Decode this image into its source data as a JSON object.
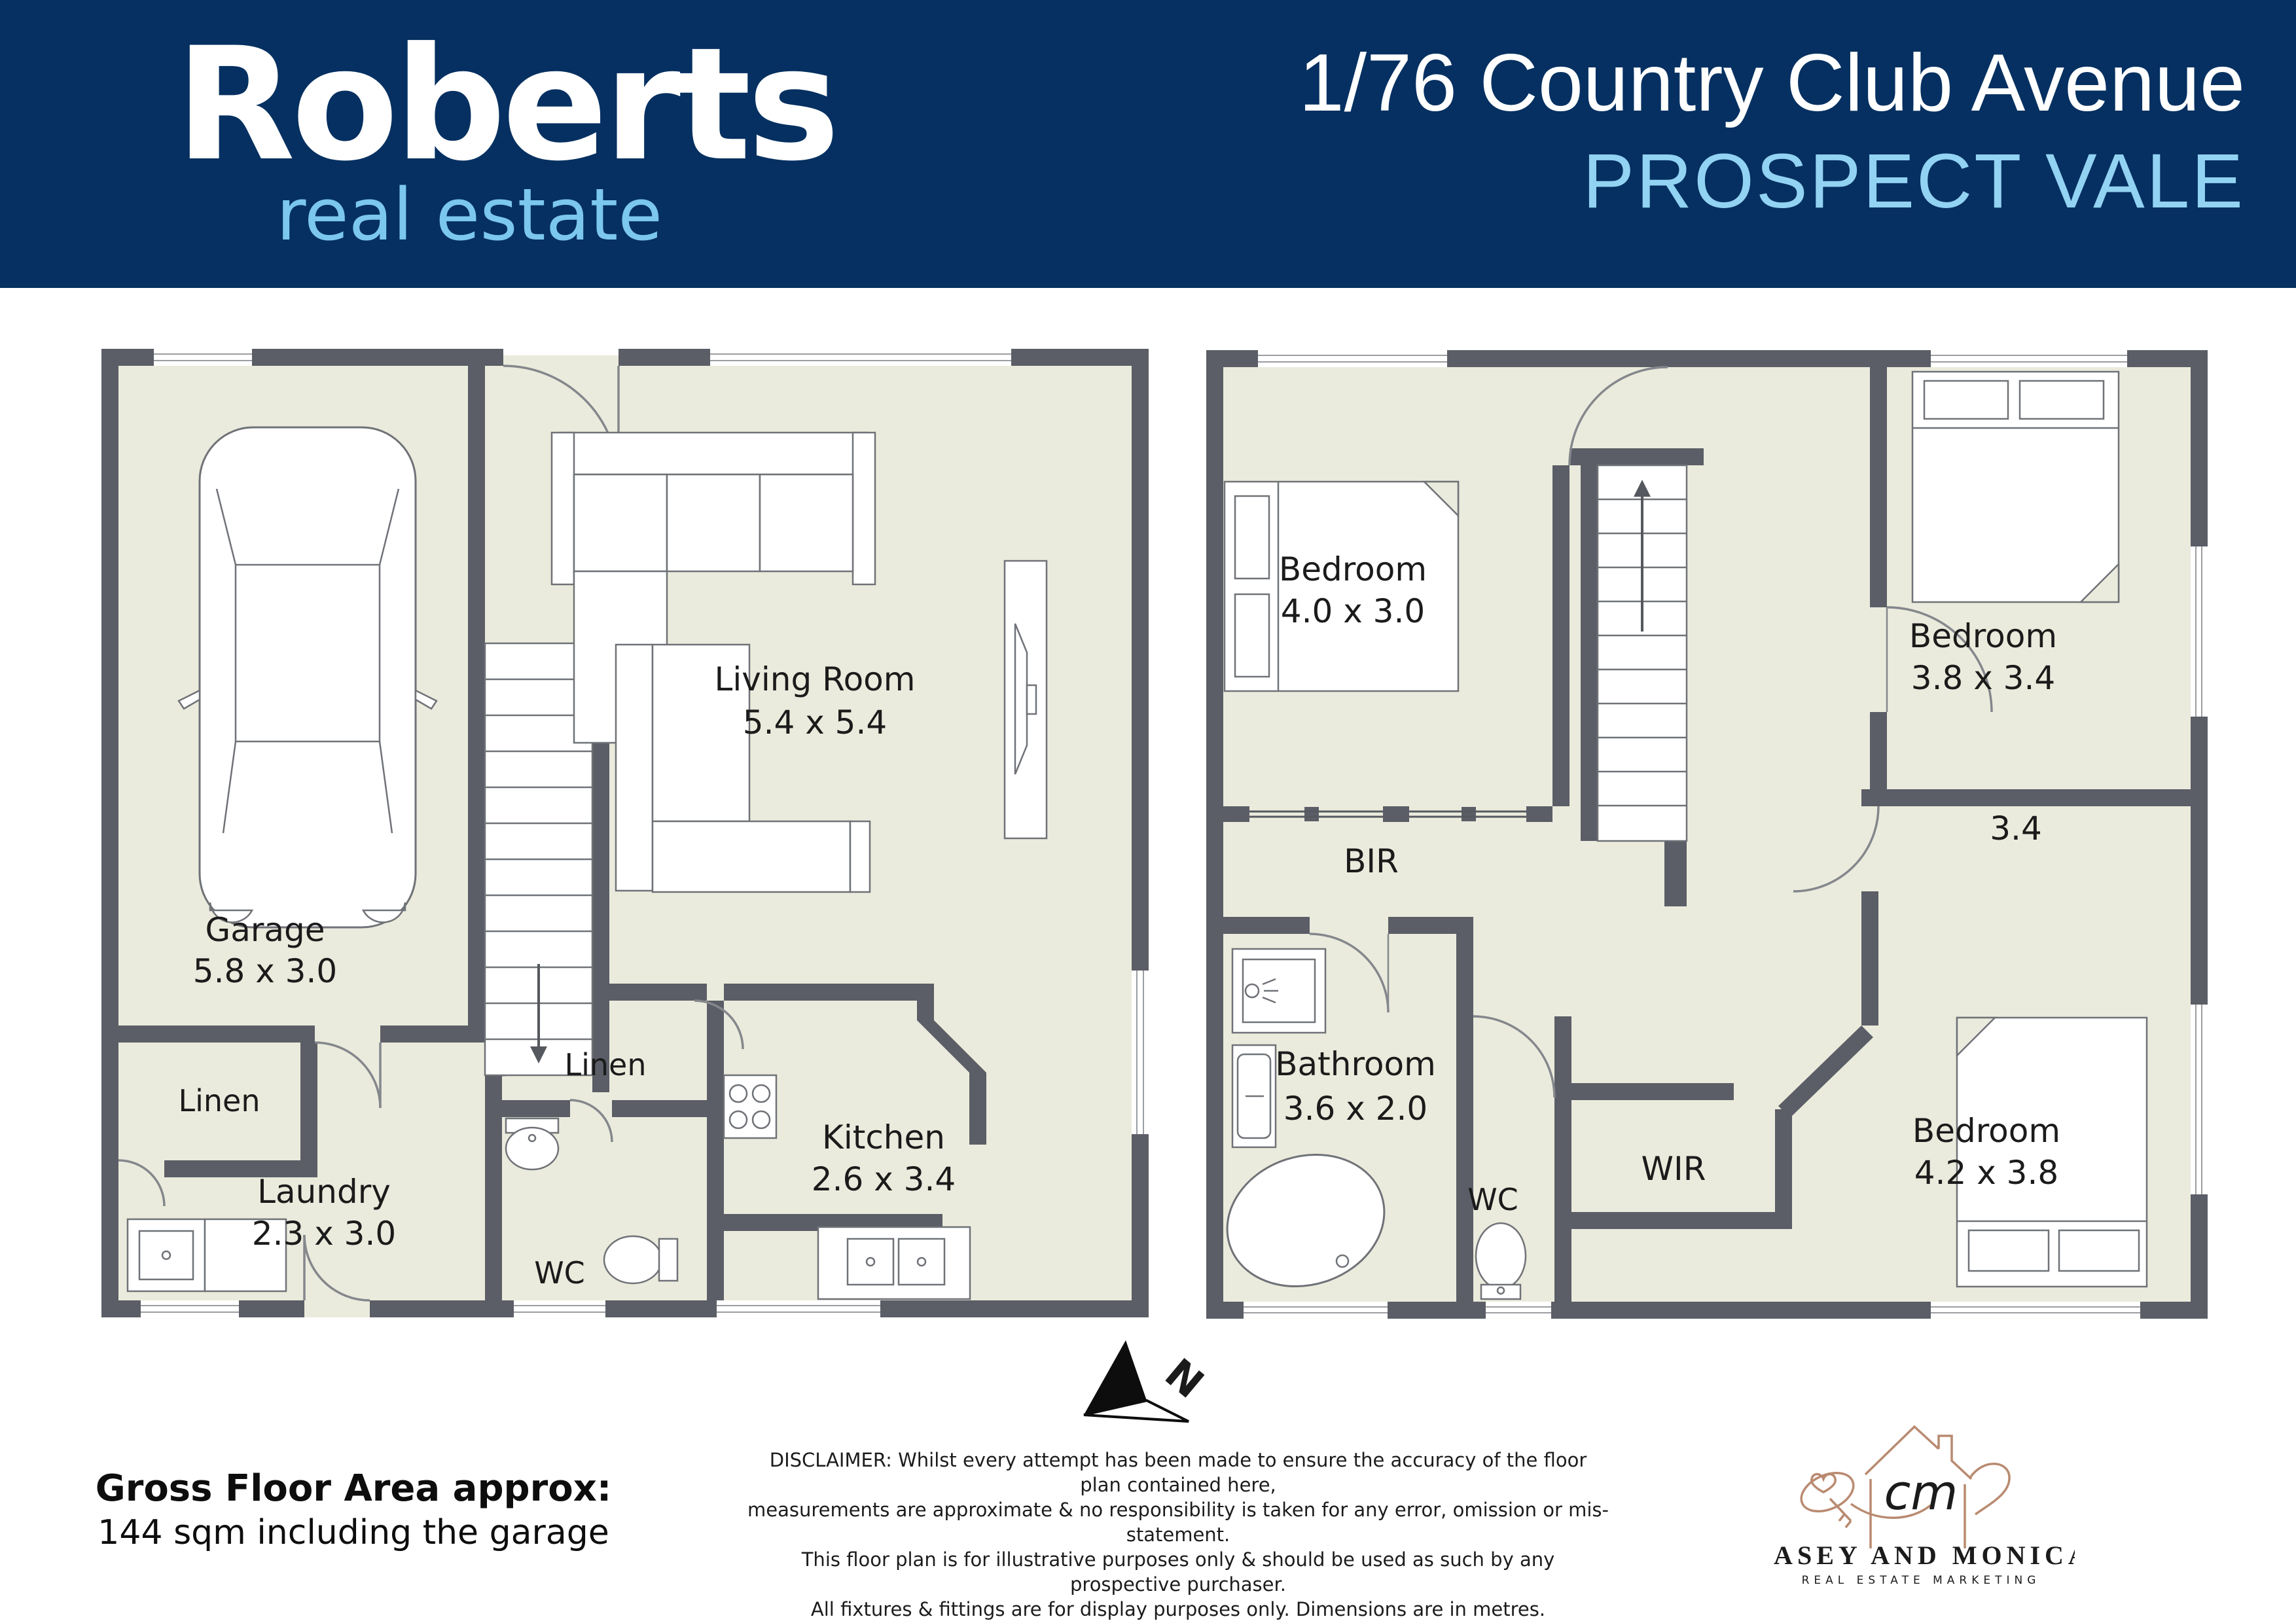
{
  "header": {
    "logo": {
      "name": "Roberts",
      "tagline": "real estate"
    },
    "address": "1/76 Country Club Avenue",
    "suburb": "PROSPECT VALE"
  },
  "plans": {
    "ground": {
      "garage": {
        "name": "Garage",
        "dims": "5.8 x 3.0"
      },
      "living": {
        "name": "Living Room",
        "dims": "5.4 x 5.4"
      },
      "kitchen": {
        "name": "Kitchen",
        "dims": "2.6 x 3.4"
      },
      "laundry": {
        "name": "Laundry",
        "dims": "2.3 x 3.0"
      },
      "linen_left": {
        "name": "Linen"
      },
      "linen_mid": {
        "name": "Linen"
      },
      "wc": {
        "name": "WC"
      }
    },
    "upper": {
      "bedroom1": {
        "name": "Bedroom",
        "dims": "4.0 x 3.0"
      },
      "bedroom2": {
        "name": "Bedroom",
        "dims": "3.8 x 3.4"
      },
      "bedroom3": {
        "name": "Bedroom",
        "dims": "4.2 x 3.8"
      },
      "bathroom": {
        "name": "Bathroom",
        "dims": "3.6 x 2.0"
      },
      "wc": {
        "name": "WC"
      },
      "wir": {
        "name": "WIR"
      },
      "bir": {
        "name": "BIR"
      },
      "dim_label": "3.4"
    }
  },
  "compass": {
    "north_label": "N"
  },
  "footer": {
    "gfa_title": "Gross Floor Area approx:",
    "gfa_value": "144 sqm including the garage",
    "disclaimer": [
      "DISCLAIMER: Whilst every attempt has been made to ensure the accuracy of the floor plan contained here,",
      "measurements are approximate & no responsibility is taken for any error, omission or mis-statement.",
      "This floor plan is for illustrative purposes only & should be used as such by any prospective purchaser.",
      "All fixtures & fittings are for display purposes only. Dimensions are in metres.",
      "For terms & conditions of use, please refer to caseyandmonica.com.au",
      "DO NOT EDIT OR REDISTRIBUTE",
      "©2024 Casey and Monica Real Estate Marketing Pty Ltd."
    ],
    "marketing_logo": {
      "initials": "cm",
      "name": "CASEY AND MONICA",
      "tagline": "REAL ESTATE MARKETING"
    }
  },
  "colors": {
    "header_bg": "#053061",
    "logo_blue": "#7cc7ec",
    "suburb_blue": "#92d2f2",
    "wall": "#5b5e66",
    "floor": "#ebebdd",
    "marketing_gold": "#b98a70"
  }
}
